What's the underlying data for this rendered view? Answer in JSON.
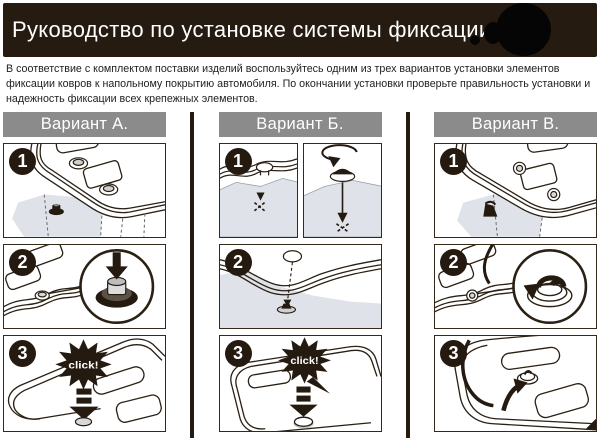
{
  "header": {
    "title": "Руководство по установке системы фиксации",
    "logo": "redacted-black-circle"
  },
  "intro": "В соответствие с комплектом поставки изделий воспользуйтесь одним из трех вариантов установки элементов фиксации ковров к напольному покрытию автомобиля. По окончании установки проверьте правильность установки и надежность фиксации всех крепежных элементов.",
  "columns": [
    {
      "label": "Вариант А.",
      "steps": [
        {
          "num": "1"
        },
        {
          "num": "2"
        },
        {
          "num": "3",
          "callout": "click!"
        }
      ]
    },
    {
      "label": "Вариант Б.",
      "steps": [
        {
          "num": "1"
        },
        {
          "num": "2"
        },
        {
          "num": "3",
          "callout": "click!"
        }
      ]
    },
    {
      "label": "Вариант В.",
      "steps": [
        {
          "num": "1"
        },
        {
          "num": "2"
        },
        {
          "num": "3"
        }
      ]
    }
  ],
  "icons": [
    "step-number-badge",
    "click-burst",
    "press-down-arrow-icon",
    "rotate-arrow-icon",
    "magnifier-circle",
    "grommet-icon",
    "eyelet-icon",
    "pin-fastener-icon",
    "screw-fastener-icon",
    "hook-fastener-icon",
    "x-mark-icon",
    "logo-circle"
  ],
  "colors": {
    "header_bg": "#261b10",
    "bar_bg": "#8b8b8b",
    "ink": "#2b2014",
    "carpet": "#dfe3e9",
    "text": "#1e1e1c"
  }
}
